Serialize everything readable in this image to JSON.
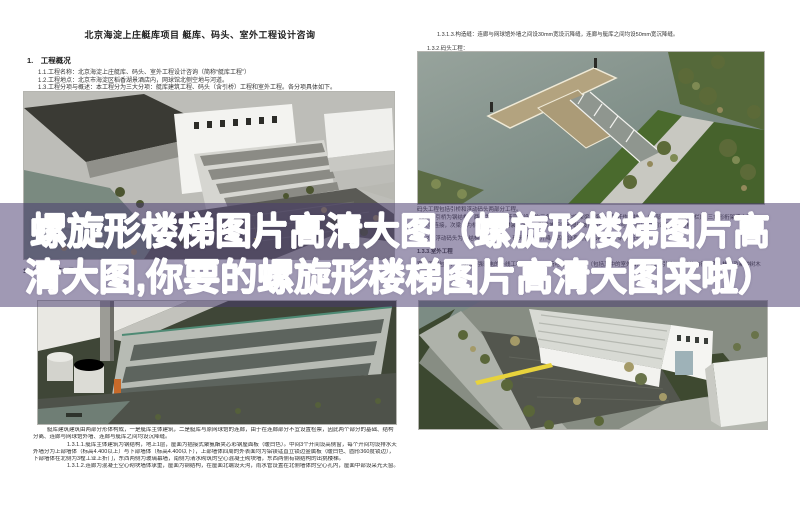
{
  "banner": {
    "line1": "螺旋形楼梯图片高清大图（螺旋形楼梯图片高",
    "line2": "清大图,你要的螺旋形楼梯图片高清大图来啦）",
    "overlay_color": "rgba(73,59,112,0.52)",
    "text_color": "#ffffff"
  },
  "doc_top_left": {
    "title": "北京海淀上庄艇库项目 艇库、码头、室外工程设计咨询",
    "section": "1.　工程概况",
    "lines": [
      "1.1.工程名称：北京海淀上庄艇库、码头、室外工程设计咨询（简称“艇库工程”）",
      "1.2.工程地点：北京市海淀区稻香湖景酒店内，网球馆北侧空地与河道。",
      "1.3.工程分项与概述：本工程分为三大分项：艇库建筑工程、码头（含引桥）工程和室外工程。各分项具体如下。"
    ],
    "sub_heading": "1.3.1.艇库建筑工程："
  },
  "doc_top_right": {
    "line1": "1.3.1.3.构造缝：连廊与网球馆外墙之间设30mm宽设沉降缝，连廊与艇库之间均设50mm宽沉降缝。",
    "line2": "1.3.2.码头工程：",
    "behind_lines": [
      "码头工程包括引桥和浮动码头两部分工程。",
      "1.3.2.1.引桥为钢结构，两侧为利用栏杆高度设计的三角形截面的桁架梁，梁的上弦杆作为扶手（局部附加玻璃扶手栏），三角形桁架梁之间",
      "设次梁连接，次梁上为桥面板，桥面铺装透水砖，引桥坡道按无障碍坡度设计，引桥与浮动码头之间设置活动搭板。",
      "1.3.2.2.浮动码头为钢结构浮箱式码头，码头随水位升降，四周设系缆桩（详见码头专项设计）。",
      "1.3.3.室外工程",
      "室外工程包括：给排水及强弱电的外线工程，艇库四周场地的铺装工程（包括其中的室外台阶），码头引桥至道路的自行车道，栈桥及新种树木"
    ]
  },
  "doc_bottom_left": {
    "para_lines": [
      "艇库建筑建筑由两部分形体构成，一是艇库主体建筑，二是艇库与原网球馆的连廊，由于在连廊部分不宜设置检票，因此两个部分的基础、结构",
      "分离、连廊与网球馆外墙、连廊与艇库之间均设沉降缝。",
      "1.3.1.1.艇库主体建筑为钢结构，地上1层，屋面为插接式聚氨酯夹芯彩钢屋面板（暖白色）。中间3个开间设高侧窗，每个开间均设排水天沟，",
      "外墙分为上部墙体（标高4.400以上）与下部墙体（标高4.400以下），上部墙体四周的外表面均为铝镁锰直立锁边金属板（暖白色、圆形360度锁边），",
      "下部墙体在北侧为3樘工业上折门，东西两侧为玻璃幕墙，南侧为清水砌筑的空心混凝土砌块墙，东西两侧有钢结构的出挑楼梯。",
      "1.3.1.2.连廊为混凝土空心砌块墙体承重，屋面为钢结构，在屋面北端设天沟，雨水管设置在北侧墙体的空心孔内，屋面中部设采光天窗。"
    ]
  },
  "renderings": {
    "top_left": "艇库建筑群鸟瞰渲染图",
    "top_right": "码头与引桥渲染图",
    "bottom_left": "艇库主体建筑近景渲染图",
    "bottom_right": "艇库与场地道路鸟瞰渲染图"
  }
}
